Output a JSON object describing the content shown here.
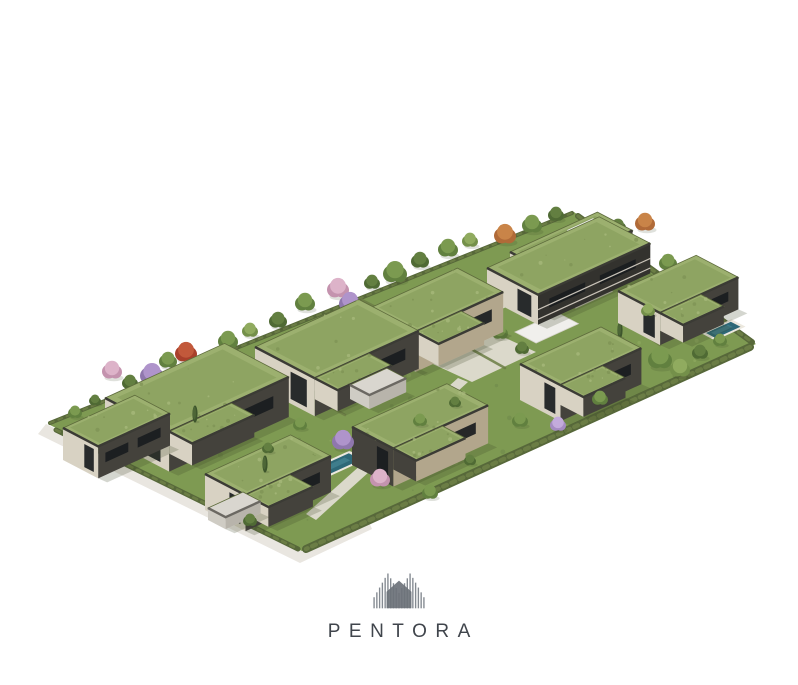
{
  "logo": {
    "wordmark": "PENTORA",
    "text_color": "#40454c",
    "mark": {
      "stripes": 19,
      "width": 54,
      "height": 46,
      "stripe_color": "#848a91",
      "house_color": "#6d727a"
    }
  },
  "scene": {
    "description": "Isometric aerial 3D rendering of a residential development with green-roof modern villas, an apartment building, private pools, gardens, trees and perimeter hedges on a white background",
    "colors": {
      "grass": "#7e9a52",
      "grass_spot_dark": "#6b854a",
      "grass_spot_light": "#94ae63",
      "roof_green": "#9cb06f",
      "roof_green2": "#8aa05e",
      "roof_fascia": "#3b3b35",
      "roof_edge": "#5e6b3c",
      "wall_cream": "#d8d2c3",
      "wall_dark": "#44423c",
      "wall_tan": "#b2a68c",
      "wall_deep": "#33322e",
      "window_dark": "#191c1f",
      "path": "#e9e6e0",
      "path2": "#e0dcd2",
      "concrete_roof": "#d9d6cf",
      "garage_lw": "#cfccc4",
      "garage_rw": "#b8b4ab",
      "garage_fascia": "#6b6862",
      "pool_water": "#2e6878",
      "pool_water2": "#4e8e9c",
      "pool_deck": "#ece8de",
      "hedge": "#57683a",
      "hedge2": "#6b7d45",
      "shadow": "#3a4526",
      "white_terrace": "#f0efec",
      "balcony_line": "#d8d2c6",
      "cypress": "#3d552c",
      "cypress2": "#4d6637"
    },
    "tree_variants": {
      "gd": [
        "#4f6a34",
        "#637f41"
      ],
      "gm": [
        "#61803f",
        "#7b9a50"
      ],
      "gl": [
        "#74904a",
        "#90ab5f"
      ],
      "pu": [
        "#8f77ad",
        "#af94cb"
      ],
      "li": [
        "#a58bc2",
        "#c3abdb"
      ],
      "pk": [
        "#c493ae",
        "#ddb3c9"
      ],
      "rd": [
        "#a8402b",
        "#c2593b"
      ],
      "or": [
        "#b06a38",
        "#c98448"
      ]
    },
    "site_outline": [
      [
        48,
        424
      ],
      [
        574,
        212
      ],
      [
        756,
        344
      ],
      [
        302,
        551
      ]
    ],
    "outer_road": [
      [
        46,
        424
      ],
      [
        302,
        550
      ],
      [
        368,
        520
      ],
      [
        372,
        529
      ],
      [
        300,
        563
      ],
      [
        38,
        434
      ]
    ],
    "paths": [
      [
        [
          168,
          426
        ],
        [
          414,
          350
        ],
        [
          424,
          356
        ],
        [
          178,
          434
        ]
      ],
      [
        [
          398,
          348
        ],
        [
          462,
          318
        ],
        [
          536,
          352
        ],
        [
          472,
          382
        ]
      ],
      [
        [
          458,
          378
        ],
        [
          468,
          382
        ],
        [
          316,
          520
        ],
        [
          306,
          514
        ]
      ],
      [
        [
          470,
          302
        ],
        [
          540,
          272
        ],
        [
          560,
          284
        ],
        [
          490,
          314
        ]
      ]
    ],
    "hedges": [
      {
        "pts": [
          [
            50,
            423
          ],
          [
            572,
            213
          ]
        ],
        "w": 4
      },
      {
        "pts": [
          [
            578,
            216
          ],
          [
            752,
            342
          ]
        ],
        "w": 6
      },
      {
        "pts": [
          [
            750,
            347
          ],
          [
            306,
            549
          ]
        ],
        "w": 8
      },
      {
        "pts": [
          [
            56,
            430
          ],
          [
            298,
            549
          ]
        ],
        "w": 5
      }
    ],
    "dividers": [
      [
        [
          230,
          352
        ],
        [
          292,
          385
        ]
      ],
      [
        [
          362,
          300
        ],
        [
          420,
          330
        ]
      ],
      [
        [
          300,
          390
        ],
        [
          345,
          415
        ]
      ],
      [
        [
          455,
          340
        ],
        [
          505,
          368
        ]
      ],
      [
        [
          620,
          318
        ],
        [
          660,
          345
        ]
      ]
    ],
    "patches": [
      {
        "P": [
          180,
          436
        ],
        "a": 36,
        "b": 16
      },
      {
        "P": [
          320,
          382
        ],
        "a": 34,
        "b": 15
      },
      {
        "P": [
          440,
          338
        ],
        "a": 34,
        "b": 15
      },
      {
        "P": [
          560,
          300
        ],
        "a": 40,
        "b": 18
      },
      {
        "P": [
          395,
          452
        ],
        "a": 36,
        "b": 16
      },
      {
        "P": [
          565,
          390
        ],
        "a": 34,
        "b": 15
      },
      {
        "P": [
          250,
          498
        ],
        "a": 32,
        "b": 14
      },
      {
        "P": [
          668,
          318
        ],
        "a": 30,
        "b": 13
      }
    ],
    "white_terrace": {
      "P": [
        515,
        332
      ],
      "a": 46,
      "b": 24
    },
    "pools": [
      {
        "P": [
          156,
          438
        ],
        "a": 46,
        "b": 15
      },
      {
        "P": [
          312,
          470
        ],
        "a": 40,
        "b": 14
      },
      {
        "P": [
          345,
          356
        ],
        "a": 26,
        "b": 11
      },
      {
        "P": [
          706,
          333
        ],
        "a": 27,
        "b": 11
      }
    ],
    "buildings": [
      {
        "kind": "apartment",
        "boxes": [
          {
            "P": [
              510,
              252
            ],
            "a": 95,
            "b": 40,
            "h": 46,
            "lw": "wall_cream",
            "rw": "wall_dark",
            "roofwhite": true
          },
          {
            "P": [
              487,
              268
            ],
            "a": 122,
            "b": 58,
            "h": 30,
            "lw": "wall_cream",
            "rw": "wall_deep"
          }
        ]
      },
      {
        "kind": "villa",
        "P": [
          618,
          291
        ],
        "a": 85,
        "b": 48,
        "h": 32,
        "lw": "wall_cream",
        "rw": "wall_dark",
        "annex": true
      },
      {
        "kind": "villa",
        "P": [
          370,
          308
        ],
        "a": 95,
        "b": 52,
        "h": 40,
        "lw": "wall_cream",
        "rw": "wall_tan",
        "annex": true
      },
      {
        "kind": "villa",
        "P": [
          255,
          347
        ],
        "a": 113,
        "b": 68,
        "h": 38,
        "lw": "wall_cream",
        "rw": "wall_dark",
        "annex": true
      },
      {
        "kind": "villa",
        "P": [
          520,
          364
        ],
        "a": 88,
        "b": 46,
        "h": 36,
        "lw": "wall_cream",
        "rw": "wall_dark",
        "annex": true
      },
      {
        "kind": "villa",
        "P": [
          105,
          398
        ],
        "a": 130,
        "b": 73,
        "h": 40,
        "lw": "wall_cream",
        "rw": "wall_dark",
        "annex": true
      },
      {
        "kind": "villa",
        "P": [
          63,
          428
        ],
        "a": 78,
        "b": 40,
        "h": 32,
        "lw": "wall_cream",
        "rw": "wall_dark"
      },
      {
        "kind": "villa",
        "P": [
          352,
          427
        ],
        "a": 103,
        "b": 47,
        "h": 38,
        "lw": "wall_dark",
        "rw": "wall_tan",
        "annex": true
      },
      {
        "kind": "villa",
        "P": [
          205,
          474
        ],
        "a": 93,
        "b": 46,
        "h": 36,
        "lw": "wall_cream",
        "rw": "wall_dark",
        "annex": true
      },
      {
        "kind": "garage",
        "P": [
          350,
          385
        ],
        "a": 40,
        "b": 22,
        "h": 14
      },
      {
        "kind": "garage",
        "P": [
          208,
          508
        ],
        "a": 38,
        "b": 20,
        "h": 12
      }
    ],
    "trees": [
      [
        75,
        412,
        7,
        "gm",
        0
      ],
      [
        95,
        400,
        6,
        "gd",
        0
      ],
      [
        112,
        370,
        10,
        "pk",
        0
      ],
      [
        130,
        382,
        8,
        "gd",
        0
      ],
      [
        152,
        374,
        12,
        "pu",
        0
      ],
      [
        168,
        360,
        9,
        "gm",
        0
      ],
      [
        186,
        352,
        11,
        "rd",
        0
      ],
      [
        204,
        362,
        8,
        "gd",
        0
      ],
      [
        228,
        340,
        10,
        "gm",
        0
      ],
      [
        250,
        330,
        8,
        "gl",
        0
      ],
      [
        278,
        320,
        9,
        "gd",
        0
      ],
      [
        305,
        302,
        10,
        "gm",
        0
      ],
      [
        338,
        288,
        11,
        "pk",
        0
      ],
      [
        350,
        302,
        11,
        "pu",
        0
      ],
      [
        372,
        282,
        8,
        "gd",
        0
      ],
      [
        395,
        272,
        12,
        "gm",
        0
      ],
      [
        420,
        260,
        9,
        "gd",
        0
      ],
      [
        448,
        248,
        10,
        "gm",
        0
      ],
      [
        470,
        240,
        8,
        "gl",
        0
      ],
      [
        505,
        234,
        11,
        "or",
        0
      ],
      [
        532,
        224,
        10,
        "gm",
        0
      ],
      [
        556,
        214,
        8,
        "gd",
        0
      ],
      [
        592,
        230,
        12,
        "gm",
        0
      ],
      [
        618,
        226,
        8,
        "gd",
        0
      ],
      [
        645,
        222,
        10,
        "or",
        0
      ],
      [
        600,
        248,
        9,
        "gl",
        0
      ],
      [
        668,
        262,
        9,
        "gm",
        0
      ],
      [
        692,
        280,
        8,
        "gd",
        0
      ],
      [
        712,
        300,
        7,
        "gm",
        0
      ],
      [
        408,
        312,
        7,
        "gd",
        0
      ],
      [
        430,
        346,
        8,
        "gm",
        0
      ],
      [
        500,
        332,
        8,
        "gm",
        0
      ],
      [
        522,
        348,
        7,
        "gd",
        0
      ],
      [
        660,
        358,
        12,
        "gm",
        1
      ],
      [
        680,
        368,
        10,
        "gl",
        1
      ],
      [
        700,
        352,
        8,
        "gd",
        1
      ],
      [
        720,
        340,
        7,
        "gm",
        1
      ],
      [
        648,
        310,
        7,
        "gl",
        1
      ],
      [
        343,
        440,
        11,
        "pu",
        1
      ],
      [
        380,
        478,
        10,
        "pk",
        1
      ],
      [
        300,
        424,
        7,
        "gm",
        1
      ],
      [
        268,
        448,
        6,
        "gd",
        1
      ],
      [
        420,
        420,
        7,
        "gm",
        1
      ],
      [
        455,
        402,
        6,
        "gd",
        1
      ],
      [
        558,
        424,
        8,
        "li",
        1
      ],
      [
        520,
        420,
        8,
        "gm",
        1
      ],
      [
        600,
        398,
        8,
        "gm",
        1
      ],
      [
        250,
        520,
        7,
        "gd",
        1
      ],
      [
        430,
        492,
        8,
        "gm",
        1
      ],
      [
        470,
        460,
        6,
        "gd",
        1
      ]
    ],
    "cypresses": [
      {
        "p": [
          302,
          396
        ],
        "front": 0
      },
      {
        "p": [
          408,
          306
        ],
        "front": 0
      },
      {
        "p": [
          540,
          310
        ],
        "front": 0
      },
      {
        "p": [
          620,
          330
        ],
        "front": 0
      },
      {
        "p": [
          265,
          464
        ],
        "front": 1
      },
      {
        "p": [
          195,
          414
        ],
        "front": 1
      }
    ]
  }
}
